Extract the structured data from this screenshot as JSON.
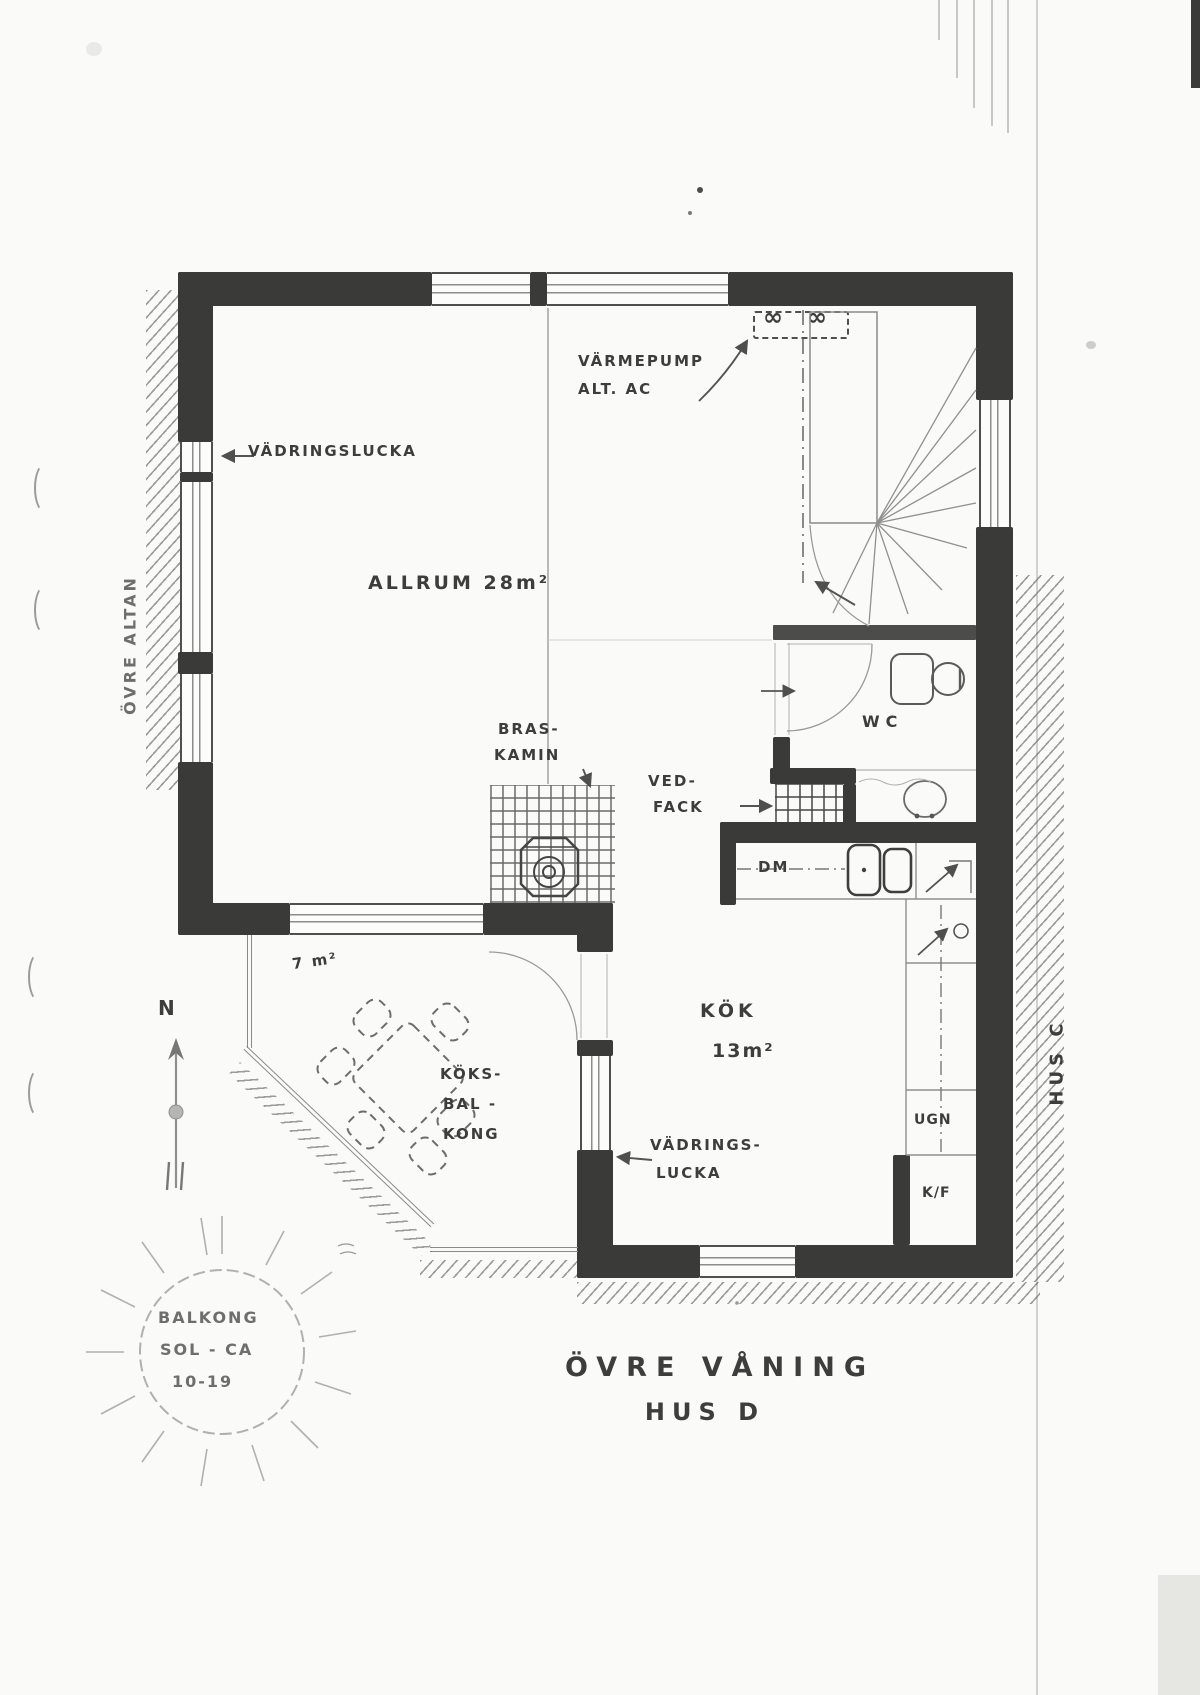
{
  "page": {
    "title_line1": "ÖVRE VÅNING",
    "title_line2": "HUS D"
  },
  "rooms": {
    "allrum_label": "ALLRUM 28m²",
    "kok_label": "KÖK",
    "kok_area": "13m²",
    "wc_label": "WC",
    "balkong_area": "7 m²",
    "koksbalkong_line1": "KÖKS-",
    "koksbalkong_line2": "BAL -",
    "koksbalkong_line3": "KONG",
    "ovre_altan_label": "ÖVRE ALTAN",
    "hus_c_label": "HUS C"
  },
  "annotations": {
    "vadringslucka_top": "VÄDRINGSLUCKA",
    "varmepump_line1": "VÄRMEPUMP",
    "varmepump_line2": "ALT. AC",
    "fan_symbol": "∞",
    "braskamin_line1": "BRAS-",
    "braskamin_line2": "KAMIN",
    "vedfack_line1": "VED-",
    "vedfack_line2": "FACK",
    "vadringslucka_kok_line1": "VÄDRINGS-",
    "vadringslucka_kok_line2": "LUCKA",
    "dm_label": "DM",
    "ugn_label": "UGN",
    "kf_label": "K/F",
    "compass_label": "N",
    "sun_line1": "BALKONG",
    "sun_line2": "SOL - CA",
    "sun_line3": "10-19"
  }
}
